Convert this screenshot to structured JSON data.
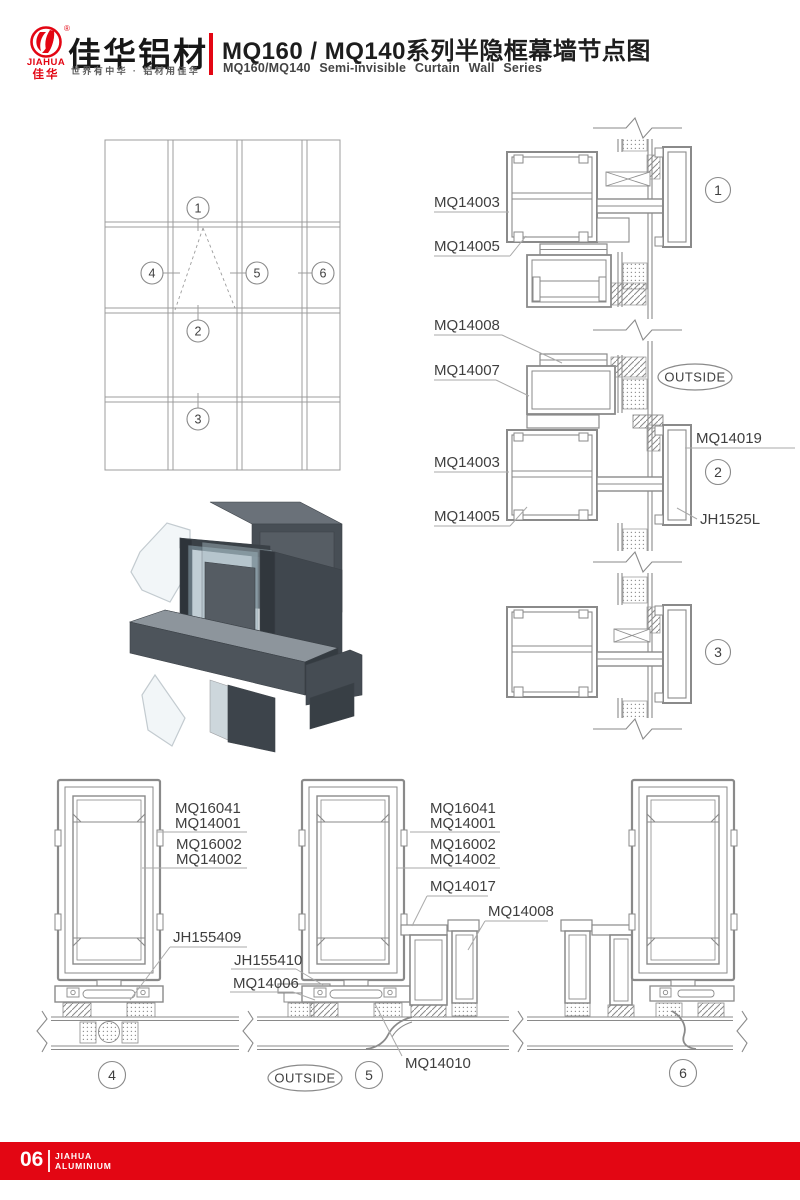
{
  "header": {
    "brand_en": "JIAHUA",
    "brand_cn": "佳华",
    "reg": "®",
    "brand_title": "佳华铝材",
    "slogan": "世界有中华 · 铝材用佳华",
    "title_cn": "MQ160 / MQ140系列半隐框幕墙节点图",
    "title_en": "MQ160/MQ140 Semi-invisible Curtain Wall Series"
  },
  "colors": {
    "accent": "#E30613",
    "line": "#8a8a8a",
    "label": "#3f3f3f"
  },
  "elevation": {
    "c1": "1",
    "c2": "2",
    "c3": "3",
    "c4": "4",
    "c5": "5",
    "c6": "6"
  },
  "vs": {
    "d1a": "MQ14003",
    "d1b": "MQ14005",
    "v1": "MQ14008",
    "v2": "MQ14007",
    "d2a": "MQ14003",
    "d2b": "MQ14005",
    "cover": "MQ14019",
    "clip": "JH1525L",
    "outside": "OUTSIDE",
    "c1": "1",
    "c2": "2",
    "c3": "3"
  },
  "ps": {
    "g4l1": "MQ16041",
    "g4l2": "MQ14001",
    "g4l3": "MQ16002",
    "g4l4": "MQ14002",
    "g4l5": "JH155409",
    "g4l6": "JH155410",
    "g4l7": "MQ14006",
    "g5l1": "MQ16041",
    "g5l2": "MQ14001",
    "g5l3": "MQ16002",
    "g5l4": "MQ14002",
    "g5l5": "MQ14017",
    "g5l6": "MQ14008",
    "g5l7": "MQ14010",
    "outside": "OUTSIDE",
    "c4": "4",
    "c5": "5",
    "c6": "6"
  },
  "footer": {
    "page": "06",
    "brand1": "JIAHUA",
    "brand2": "ALUMINIUM"
  }
}
